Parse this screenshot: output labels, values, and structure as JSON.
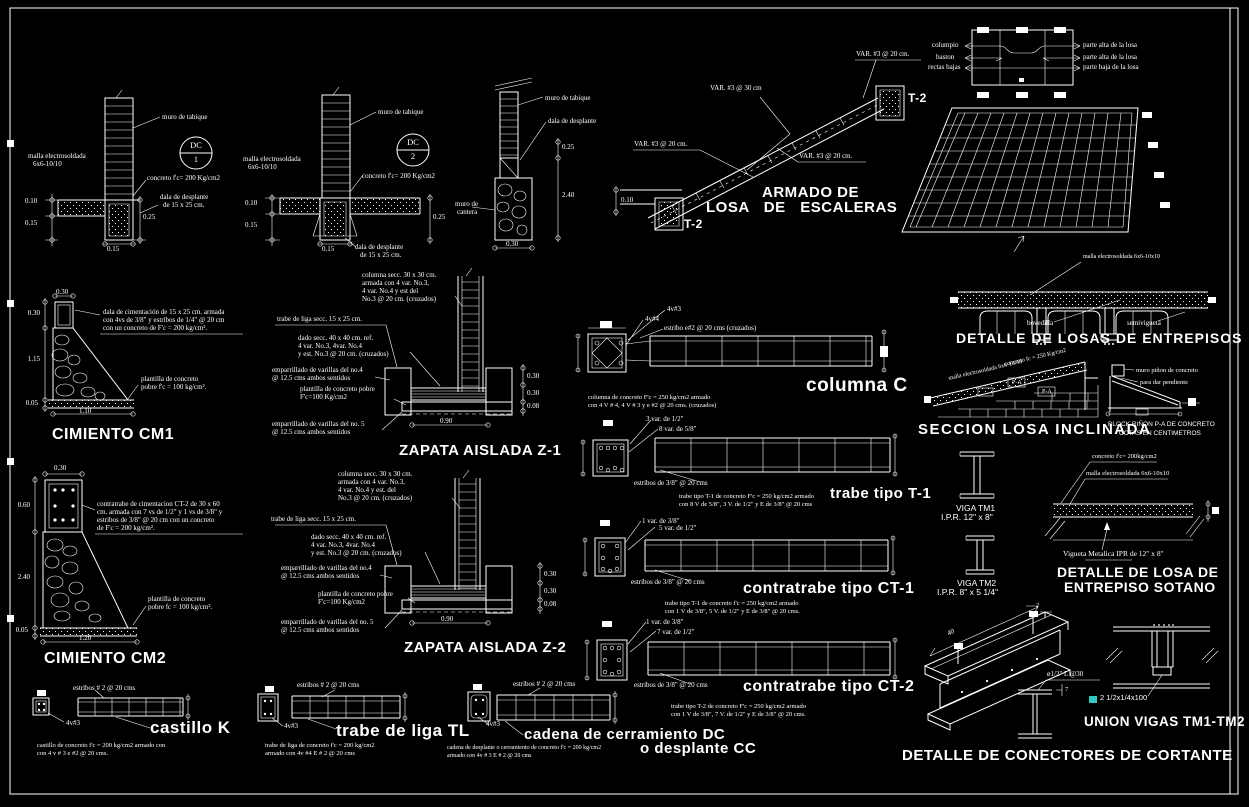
{
  "meta": {
    "background": "#000000",
    "line_color": "#ffffff",
    "plate_marker_color": "#2fc9bd"
  },
  "dc1": {
    "badge": "DC",
    "num": "1",
    "muro": "muro de tabique",
    "malla1": "malla electrosoldada",
    "malla2": "6x6-10/10",
    "concreto": "concreto f'c= 200 Kg/cm2",
    "dala1": "dala de desplante",
    "dala2": "de 15 x 25 cm.",
    "d010": "0.10",
    "d015": "0.15",
    "d025": "0.25",
    "dbase": "0.15"
  },
  "dc2": {
    "badge": "DC",
    "num": "2",
    "muro": "muro de tabique",
    "malla1": "malla electrosoldada",
    "malla2": "6x6-10/10",
    "concreto": "concreto f'c= 200 Kg/cm2",
    "dala1": "dala de desplante",
    "dala2": "de 15 x 25 cm.",
    "d010": "0.10",
    "d015": "0.15",
    "d025": "0.25",
    "dbase": "0.15"
  },
  "cantera": {
    "muro": "muro de tabique",
    "dala": "dala de desplante",
    "cant1": "muro de",
    "cant2": "cantera",
    "d025": "0.25",
    "d240": "2.40",
    "d030": "0.30"
  },
  "escaleras": {
    "title1": "ARMADO DE",
    "title2": "LOSA  DE  ESCALERAS",
    "var30": "VAR.  #3 @ 30 cm",
    "var20a": "VAR.  #3 @ 20 cm.",
    "var20b": "VAR.  #3 @ 20 cm.",
    "var20c": "VAR.  #3 @ 20 cm.",
    "t2a": "T-2",
    "t2b": "T-2",
    "d010": "0.10"
  },
  "plan": {
    "l1": "columpio",
    "l2": "baston",
    "l3": "rectas bajas",
    "r1": "parte alta de la losa",
    "r2": "parte alta de la losa",
    "r3": "parte baja de la losa"
  },
  "entrepisos": {
    "title": "DETALLE DE LOSAS DE ENTREPISOS",
    "malla": "malla electrosoldada 6x6-10x10",
    "bovedilla": "bovedilla",
    "semivigueta": "semivigueta"
  },
  "inclinada": {
    "title": "SECCION LOSA INCLINADA",
    "slope1": "malla electrosoldada 6x6-10/10",
    "slope2": "concreto fc = 250 Kg/cm2",
    "pa1": "P-A",
    "pa2": "P-A",
    "pinon1": "muro piñon de concreto",
    "pinon2": "para dar pendiente",
    "nota1": "BLOCK RIÑON P-A DE CONCRETO",
    "nota2": "COTAS EN CENTIMETROS"
  },
  "cm1": {
    "title": "CIMIENTO CM1",
    "nota": [
      "dala de cimentación de 15 x 25 cm. armada",
      "con 4vs de 3/8\" y estribos de 1/4\" @ 20 cm",
      "con un concreto de F'c = 200 kg/cm²."
    ],
    "plantilla": [
      "plantilla de concreto",
      "pobre f'c = 100 kg/cm²."
    ],
    "dtop": "0.30",
    "dl1": "0.30",
    "dl2": "1.15",
    "dl3": "0.05",
    "db": "1.10"
  },
  "z1": {
    "title": "ZAPATA AISLADA Z-1",
    "columna": [
      "columna secc. 30 x 30 cm.",
      "armada con 4 var. No.3,",
      "4 var. No.4  y est  del",
      "No.3 @ 20 cm. (cruzados)"
    ],
    "trabe": "trabe de liga secc. 15 x 25 cm.",
    "dado": [
      "dado secc. 40 x 40 cm. ref.",
      "4 var. No.3, 4var. No.4",
      "y est. No.3 @ 20 cm. (cruzados)"
    ],
    "emp4": [
      "emparrillado de varillas del no.4",
      "@ 12.5 cms ambos sentidos"
    ],
    "plantilla": [
      "plantilla de concreto pobre",
      "F'c=100 Kg/cm2"
    ],
    "emp5": [
      "emparrillado de varillas del no. 5",
      "@ 12.5 cms ambos sentidos"
    ],
    "dr1": "0.30",
    "dr2": "0.30",
    "dr3": "0.08",
    "db": "0.90"
  },
  "cm2": {
    "title": "CIMIENTO CM2",
    "nota": [
      "contratrabe de cimentacion CT-2 de 30 x 60",
      "cm. armada con 7 vs de 1/2\" y 1 vs de 3/8\" y",
      "estribos de 3/8\" @ 20 cm con un concreto",
      "de F'c = 200 kg/cm²."
    ],
    "plantilla": [
      "plantilla de concreto",
      "pobre fc = 100 kg/cm²."
    ],
    "dtop": "0.30",
    "dl1": "0.60",
    "dl2": "2.40",
    "dl3": "0.05",
    "db": "1.20"
  },
  "z2": {
    "title": "ZAPATA AISLADA Z-2",
    "columna": [
      "columna secc. 30 x 30 cm.",
      "armada con 4 var. No.3,",
      "4 var. No.4  y est. del",
      "No.3 @ 20 cm. (cruzados)"
    ],
    "trabe": "trabe de liga secc. 15 x 25 cm.",
    "dado": [
      "dado secc. 40 x 40 cm. ref.",
      "4 var. No.3, 4var. No.4",
      "y est. No.3 @ 20 cm. (cruzados)"
    ],
    "emp4": [
      "emparrillado de varillas del no.4",
      "@ 12.5 cms ambos sentidos"
    ],
    "plantilla": [
      "plantilla de concreto pobre",
      "F'c=100 Kg/cm2"
    ],
    "emp5": [
      "emparrillado de varillas del no. 5",
      "@ 12.5 cms ambos sentidos"
    ],
    "dr1": "0.30",
    "dr2": "0.30",
    "dr3": "0.08",
    "db": "0.90"
  },
  "colc": {
    "title": "columna C",
    "v3": "4v#3",
    "v4": "4v#4",
    "estribo": "estribo e#2 @ 20 cms (cruzados)",
    "nota": [
      "columna de concreto F'c = 250 kg/cm2 armado",
      "con 4 V # 4, 4 V # 3 y  e #2 @ 20 cms. (cruzados)"
    ]
  },
  "t1": {
    "title": "trabe tipo T-1",
    "l1": "3 var. de 1/2\"",
    "l2": "8 var. de 5/8\"",
    "estribos": "estribos de 3/8\" @ 20 cms",
    "nota": [
      "trabe tipo T-1 de concreto F'c = 250 kg/cm2 armado",
      "con 8 V de 5/8\", 3 V. de 1/2\"  y E de 3/8\" @ 20 cms"
    ]
  },
  "ct1": {
    "title": "contratrabe tipo CT-1",
    "l1": "1 var. de 3/8\"",
    "l2": "5 var. de 1/2\"",
    "estribos": "estribos de 3/8\" @ 20 cms",
    "nota": [
      "trabe tipo T-1 de concreto f'c = 250 kg/cm2 armado",
      "con 1 V de 3/8\", 5 V. de 1/2\"  y E de 3/8\" @ 20 cms."
    ]
  },
  "ct2": {
    "title": "contratrabe tipo CT-2",
    "l1": "1 var. de 3/8\"",
    "l2": "7 var. de 1/2\"",
    "estribos": "estribos de 3/8\" @ 20 cms",
    "nota": [
      "trabe tipo T-2 de concreto F'c = 250 kg/cm2 armado",
      "con 1 V de 3/8\", 7 V. de 1/2\" y E de 3/8\" @ 20 cms."
    ]
  },
  "cast": {
    "title": "castillo K",
    "estribos": "estribos # 2 @ 20 cms",
    "v3": "4v#3",
    "nota": [
      "castillo de concreto f'c = 200 kg/cm2 armado con",
      "con 4 v # 3  e #2 @ 20 cms."
    ]
  },
  "tl": {
    "title": "trabe de liga TL",
    "estribos": "estribos # 2 @ 20 cms",
    "v3": "4v#3",
    "nota": [
      "trabe de liga de concreto f'c = 200 kg/cm2",
      "armado con 4v #4 E # 2 @ 20 cms"
    ]
  },
  "cad": {
    "title1": "cadena de cerramiento  DC",
    "title2": "o desplante CC",
    "estribos": "estribos # 2 @ 20 cms",
    "v3": "4v#3",
    "nota": [
      "cadena de desplante o cerramiento de concreto f'c = 200 kg/cm2",
      "armado con 4v # 3 E # 2 @ 20 cms"
    ]
  },
  "vigas": {
    "tm1a": "VIGA  TM1",
    "tm1b": "I.P.R.  12\"  x  8\"",
    "tm2a": "VIGA  TM2",
    "tm2b": "I.P.R.  8\"  x  5 1/4\""
  },
  "sotano": {
    "title1": "DETALLE DE LOSA DE",
    "title2": "ENTREPISO SOTANO",
    "concreto": "concreto f'c= 200kg/cm2",
    "malla": "malla electrosoldada 6x6-10x10",
    "vigueta": "Vigueta Metalica IPR de 12\" x 8\""
  },
  "union": {
    "title": "UNION VIGAS TM1-TM2",
    "placa": "2  1/2x1/4x100"
  },
  "conect": {
    "title": "DETALLE DE CONECTORES DE CORTANTE",
    "tornillo": "ø1/2\"  L @30",
    "dim40": "40",
    "dim2": "2",
    "dim7": "7"
  }
}
